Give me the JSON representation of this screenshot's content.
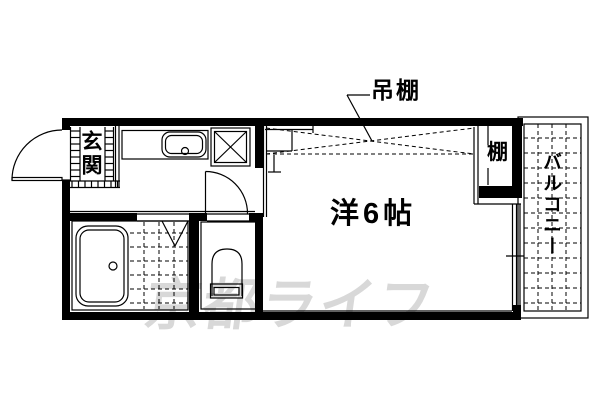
{
  "colors": {
    "line": "#000000",
    "background": "#ffffff",
    "watermark": "#d8d8d8"
  },
  "floor_plan": {
    "rooms": {
      "entrance": {
        "label": "玄関"
      },
      "main_room": {
        "label": "洋6帖"
      },
      "balcony": {
        "label": "バルコニー"
      },
      "shelf": {
        "label": "棚"
      },
      "hanging_shelf": {
        "label": "吊棚"
      }
    },
    "watermark": {
      "text": "京都ライフ"
    },
    "fixtures": [
      "entry-door",
      "kitchen-sink",
      "washing-machine-pan",
      "room-door-opening",
      "bath-folding-door",
      "bathtub",
      "bath-tile-floor",
      "toilet",
      "toilet-door",
      "overhead-shelf-dashed",
      "shelf-closet",
      "sliding-window",
      "balcony-grid"
    ]
  }
}
